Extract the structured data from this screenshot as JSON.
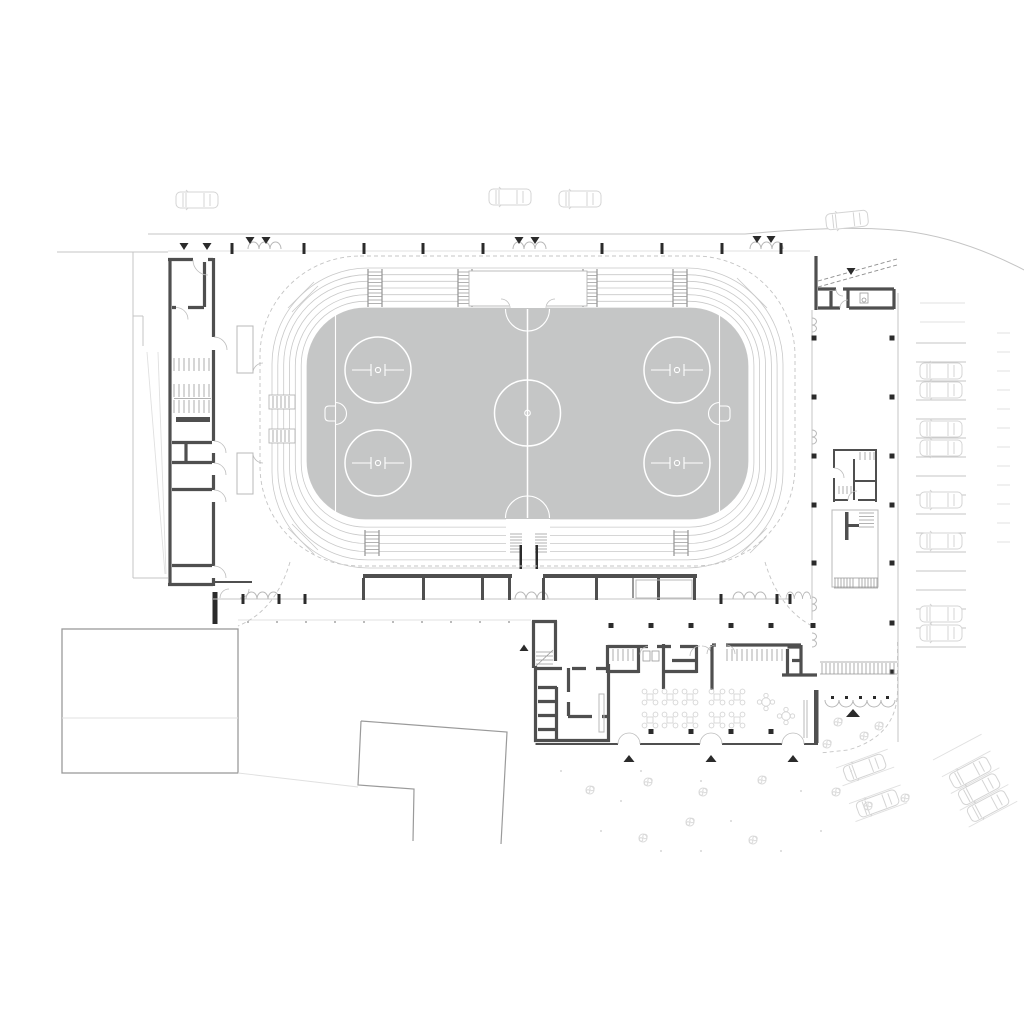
{
  "meta": {
    "description": "Architectural ground-floor site plan of an ice-rink sports complex with oval grandstand, locker building, entrance hall, colonnades and parking"
  },
  "colors": {
    "background": "#ffffff",
    "ice": "#c5c6c6",
    "marking": "#ffffff",
    "wall": "#4f4f4f",
    "wall_dark": "#2b2b2b",
    "line": "#c4c4c4",
    "faint": "#e0e0e0",
    "stands": "#c9c9c9",
    "comb": "#999999",
    "dashed": "#c4c4c4",
    "car": "#d4d4d4",
    "tree": "#d9d9d9",
    "furniture": "#d4d4d4",
    "door_arc": "#bdbdbd"
  },
  "elements": {
    "ice_rink": {
      "name": "ice-hockey-rink",
      "center_circles": 1,
      "faceoff_circles": 4,
      "goal_creases": 2,
      "goals": 2,
      "goal_lines": 2,
      "center_line": 1
    },
    "grandstand": {
      "name": "grandstand-oval",
      "seating_rows": 7,
      "aisle_stairs": 6,
      "side_vomitories": 2,
      "top_platform": 1,
      "south_vomitory": 1
    },
    "buildings": {
      "west_wing": {
        "name": "west-locker-building",
        "stair_flights": 3
      },
      "north_east_kiosk": {
        "name": "entrance-kiosk"
      },
      "east_pavilion": {
        "name": "east-service-pavilion",
        "stair_flights": 2
      },
      "south_hall": {
        "name": "south-entrance-hall",
        "cross_tables": 10,
        "round_tables": 2,
        "coat_rack_rooms": 2
      },
      "existing_southwest": {
        "name": "existing-building-outline"
      },
      "existing_south": {
        "name": "existing-building-outline"
      },
      "existing_west": {
        "name": "existing-ramp-structure"
      }
    },
    "site": {
      "north_fence_posts": 9,
      "north_gates": 3,
      "south_fence_posts": 6,
      "south_gates": 4,
      "east_colonnade_columns": 12,
      "south_terrace_columns": 10,
      "canopy_shelters": 2,
      "bike_racks": 2,
      "hedge_rows": 1,
      "picket_fence_rows": 1
    },
    "vehicles": {
      "street_cars": 4,
      "east_parking_cars": 8,
      "south_east_parking_cars": 5,
      "east_parking_stalls": 16,
      "angled_stalls": 9
    },
    "markers": {
      "entry_arrows_down": 9,
      "entry_arrows_up": 5
    },
    "vegetation": {
      "trees": 14
    }
  }
}
